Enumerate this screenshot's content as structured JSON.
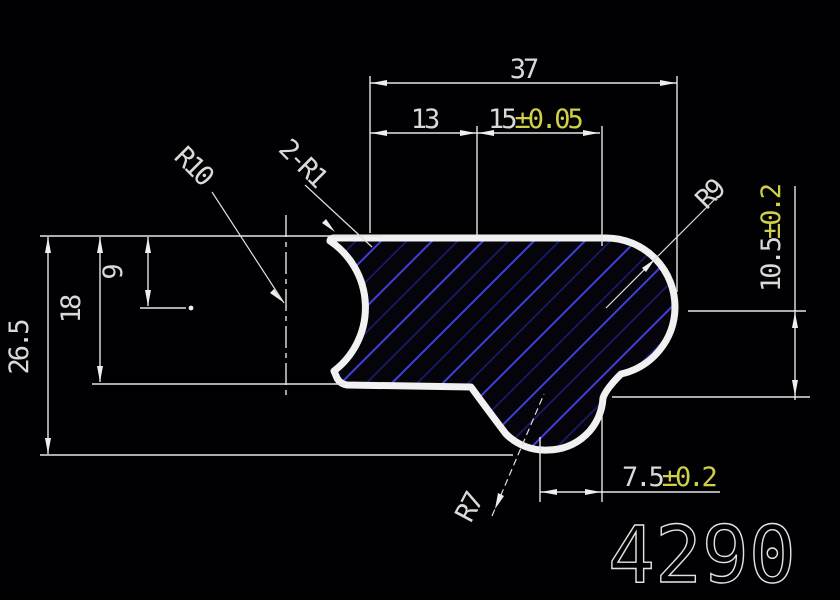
{
  "drawing": {
    "number": "4290",
    "dims": {
      "total_width": "37",
      "left_width": "13",
      "mid_width": "15",
      "mid_width_tol": "±0.05",
      "total_height": "26.5",
      "body_height": "18",
      "r10_center_depth": "9",
      "right_height": "10.5",
      "right_height_tol": "±0.2",
      "bottom_width": "7.5",
      "bottom_width_tol": "±0.2"
    },
    "radius_labels": {
      "left_arc": "R10",
      "corner_fillets": "2-R1",
      "right_lobe": "R9",
      "bottom_lobe": "R7"
    },
    "colors": {
      "background": "#000000",
      "line": "#e6e6e6",
      "dim_text": "#d9d9d9",
      "tolerance_text": "#cfcf4a",
      "hatch_bright": "#4040d8",
      "hatch_dim": "#1d1d7a",
      "outline": "#f1f1f1"
    }
  }
}
